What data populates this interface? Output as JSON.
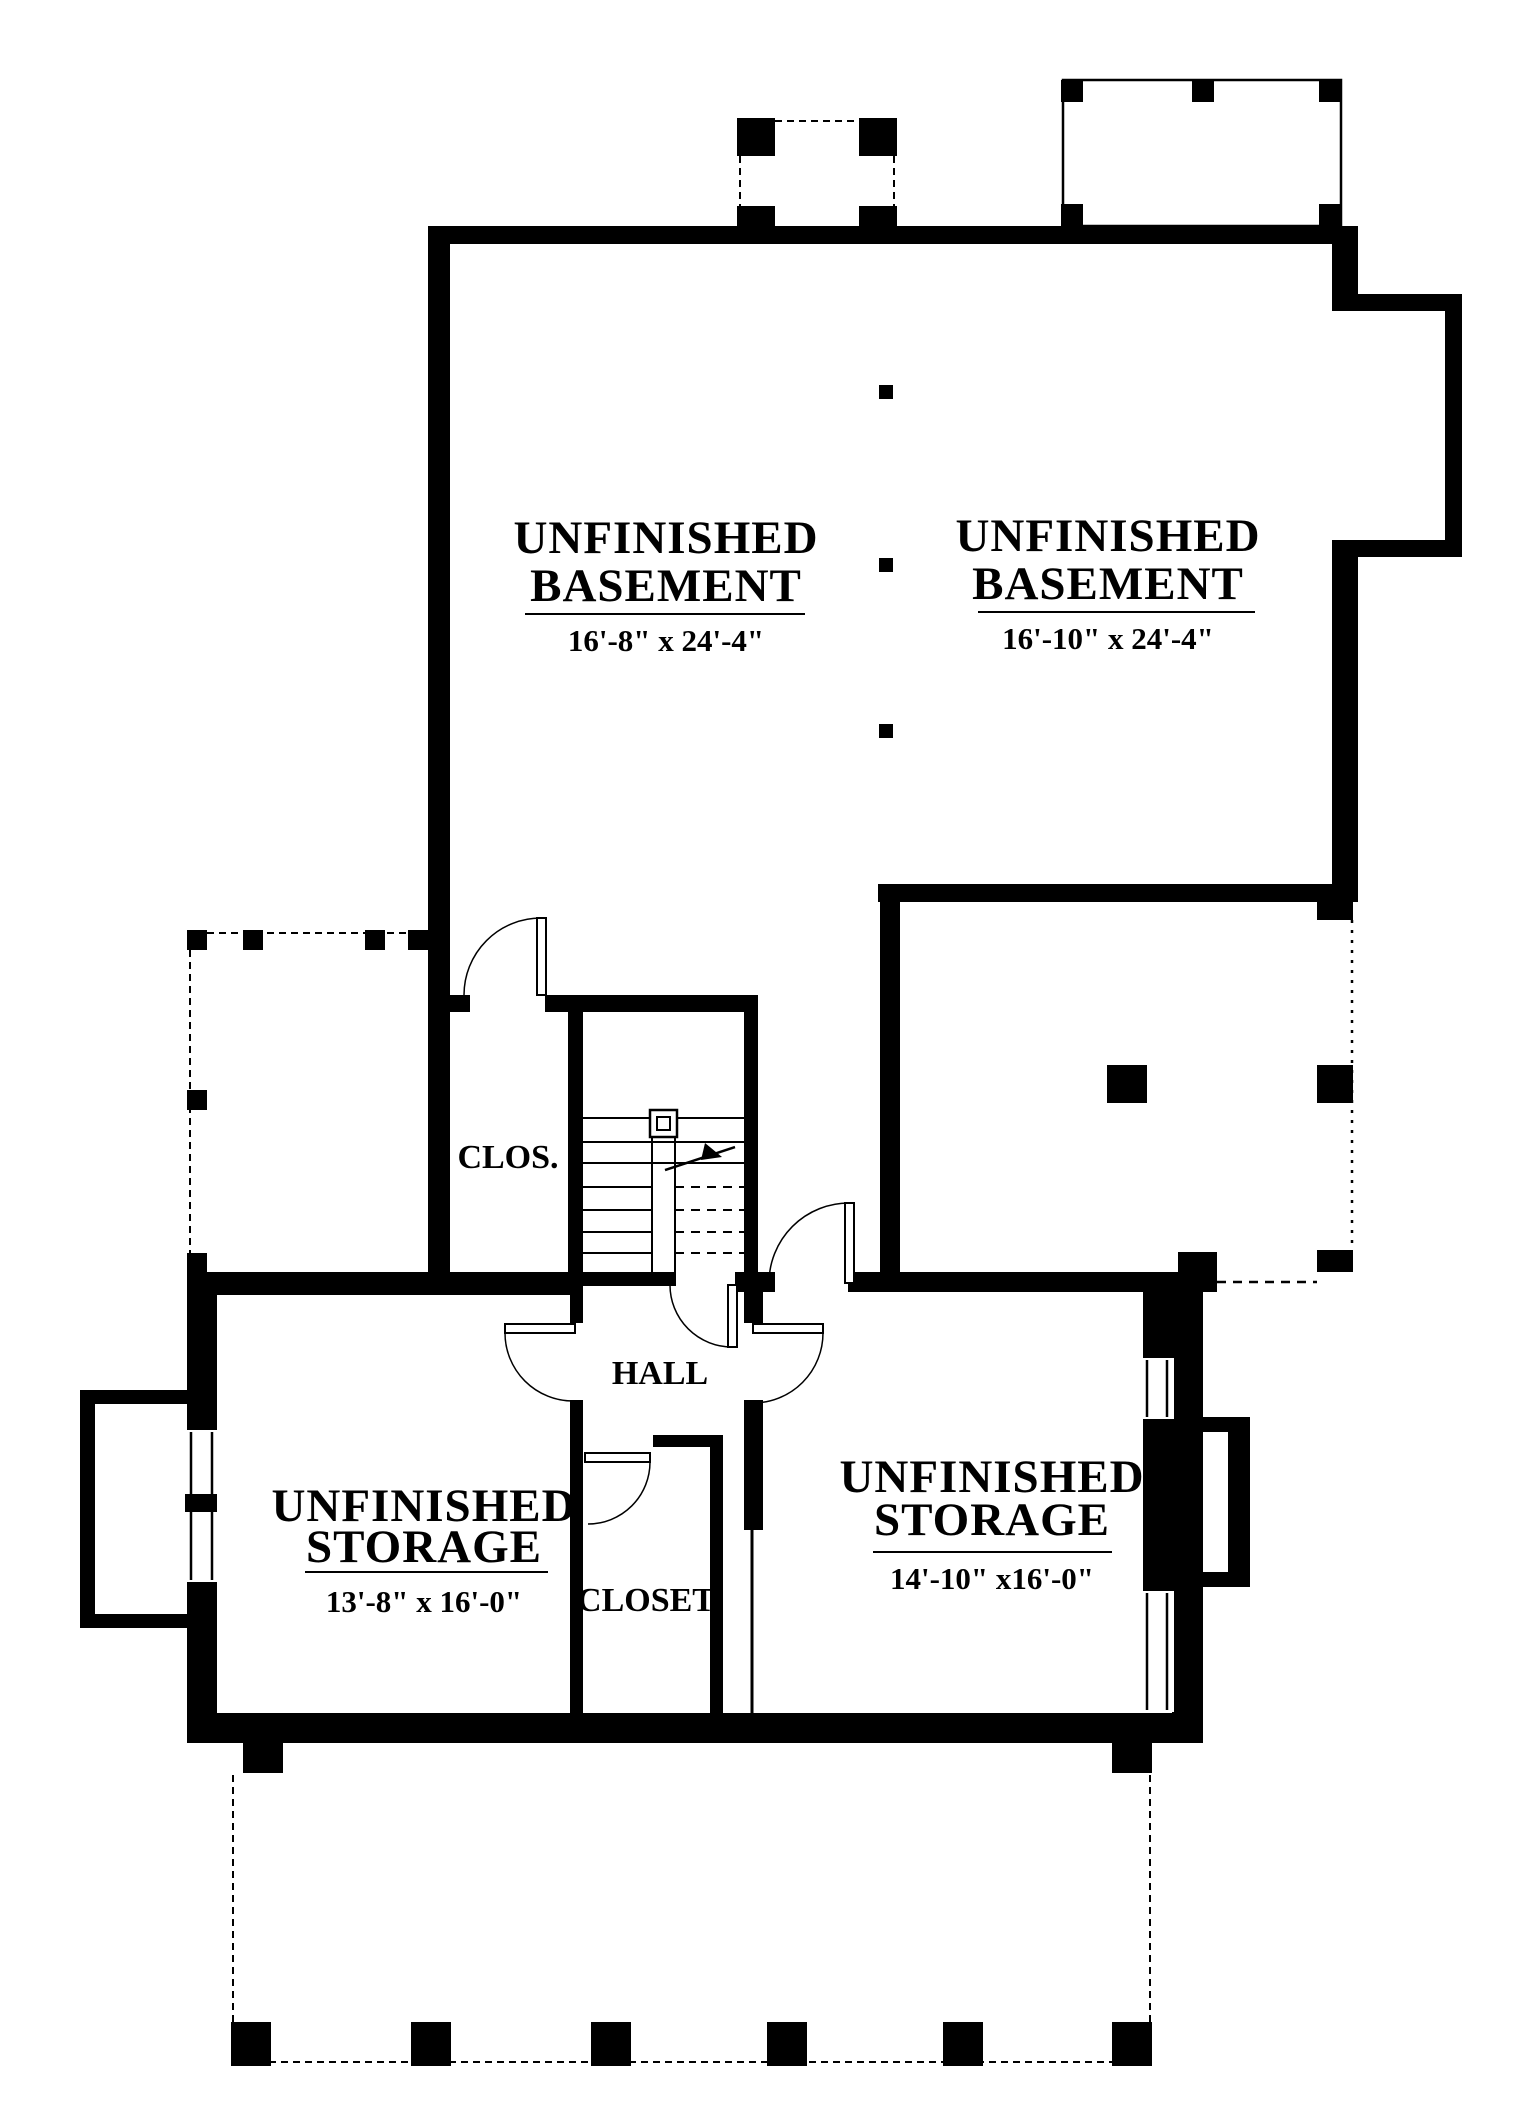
{
  "plan": {
    "colors": {
      "ink": "#000000",
      "paper": "#ffffff"
    },
    "rooms": {
      "basement_left": {
        "line1": "UNFINISHED",
        "line2": "BASEMENT",
        "dims": "16'-8\" x 24'-4\""
      },
      "basement_right": {
        "line1": "UNFINISHED",
        "line2": "BASEMENT",
        "dims": "16'-10\" x 24'-4\""
      },
      "storage_left": {
        "line1": "UNFINISHED",
        "line2": "STORAGE",
        "dims": "13'-8\" x 16'-0\""
      },
      "storage_right": {
        "line1": "UNFINISHED",
        "line2": "STORAGE",
        "dims": "14'-10\" x16'-0\""
      },
      "closet_small": {
        "label": "CLOS."
      },
      "hall": {
        "label": "HALL"
      },
      "closet": {
        "label": "CLOSET"
      }
    }
  }
}
